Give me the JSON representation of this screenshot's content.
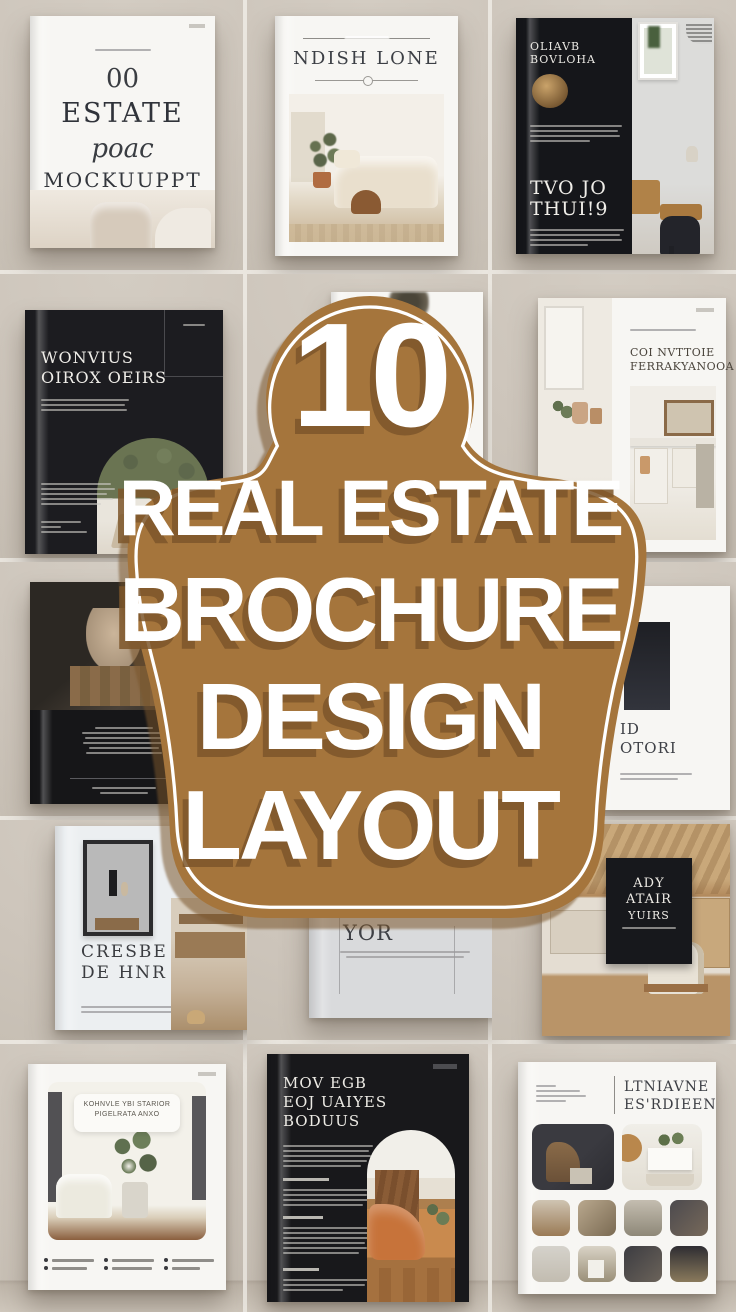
{
  "page": {
    "background": "#cdc5bb",
    "seam_color": "#eae6df"
  },
  "badge": {
    "number": "10",
    "line1": "REAL ESTATE",
    "line2": "BROCHURE",
    "line3": "DESIGN",
    "line4": "LAYOUT",
    "fill_color": "#a5753c",
    "outline_color": "#ffffff",
    "text_color": "#ffffff",
    "letter_shadow_color": "#7d5628"
  },
  "brochures": {
    "estate_mockup": {
      "number": "00",
      "title": "ESTATE",
      "script_word": "poac",
      "subtitle": "MOCKUUPPT"
    },
    "ndish_lone": {
      "title": "NDISH LONE"
    },
    "oliavb": {
      "kicker_line1": "OLIAVB",
      "kicker_line2": "BOVLOHA",
      "title_line1": "TVO JO",
      "title_line2": "THUI!9"
    },
    "wonvius": {
      "title_line1": "WONVIUS",
      "title_line2": "OIROX OEIRS"
    },
    "coi_nvttoie": {
      "title_line1": "COI NVTTOIE",
      "title_line2": "FERRAKYANOOA"
    },
    "aid_otori": {
      "line1": "ID",
      "line2": "OTORI"
    },
    "cresbe": {
      "title_line1": "CRESBE",
      "title_line2": "DE HNR"
    },
    "dor_chonig": {
      "title_line1": "DOR CHONIG",
      "title_line2": "YOR"
    },
    "ady_poster": {
      "line1": "ADY",
      "line2": "ATAIR",
      "line3": "YUIRS"
    },
    "kohnvle": {
      "label_line1": "KOHNVLE YBI STARIOR",
      "label_line2": "PIGELRATA ANXO"
    },
    "mov_egb": {
      "title_line1": "MOV EGB",
      "title_line2": "EOJ UAIYES",
      "title_line3": "BODUUS"
    },
    "ltniavne": {
      "title_line1": "LTNIAVNE",
      "title_line2": "ES'RDIEEN"
    }
  }
}
